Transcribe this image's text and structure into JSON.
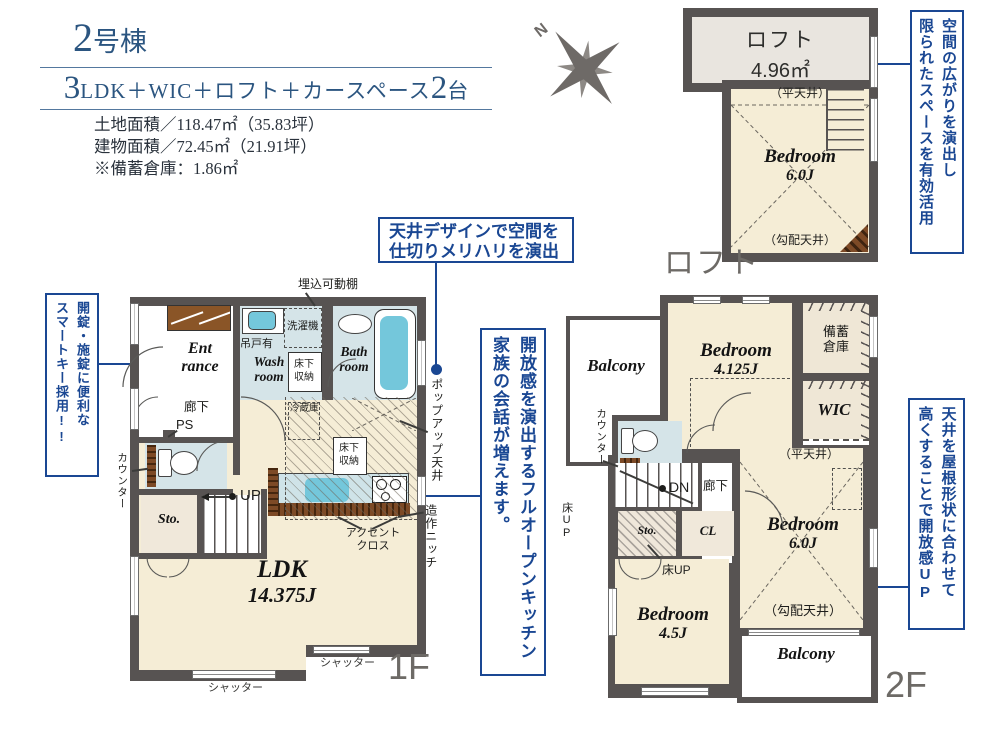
{
  "header": {
    "building_no": "2",
    "building_suffix": "号棟",
    "layout_big1": "3",
    "layout_text": "LDK＋WIC＋ロフト＋カースペース",
    "layout_big2": "2",
    "layout_unit": "台",
    "land_area": "土地面積／118.47㎡（35.83坪）",
    "building_area": "建物面積／72.45㎡（21.91坪）",
    "storage_note": "※備蓄倉庫：1.86㎡"
  },
  "compass": {
    "north": "N"
  },
  "callouts": {
    "smart_key": {
      "col_right": "開錠・施錠に便利な",
      "col_left": "スマートキー採用!!"
    },
    "ceiling_design": {
      "line1": "天井デザインで空間を",
      "line2": "仕切りメリハリを演出"
    },
    "open_kitchen": {
      "col_right": "開放感を演出するフルオープンキッチン",
      "col_left": "家族の会話が増えます。"
    },
    "loft_space": {
      "col_right": "空間の広がりを演出し",
      "col_left": "限られたスペースを有効活用"
    },
    "roof_ceiling": {
      "col_right": "天井を屋根形状に合わせて",
      "col_left": "高くすることで開放感UP"
    }
  },
  "loft": {
    "floor_label": "ロフト",
    "room": "ロフト",
    "area": "4.96㎡",
    "bedroom": "Bedroom",
    "bedroom_area": "6.0J",
    "flat_ceiling": "（平天井）",
    "slope_ceiling": "（勾配天井）"
  },
  "f1": {
    "floor_label": "1F",
    "entrance1": "Ent",
    "entrance2": "rance",
    "hallway": "廊下",
    "ps": "PS",
    "counter": "カウンター",
    "sto": "Sto.",
    "up": "UP",
    "wash1": "Wash",
    "wash2": "room",
    "hanging": "吊戸有",
    "washer": "洗濯機",
    "shelf": "埋込可動棚",
    "uf1": "床下",
    "uf2": "収納",
    "bath1": "Bath",
    "bath2": "room",
    "fridge": "冷蔵庫",
    "ldk": "LDK",
    "ldk_area": "14.375J",
    "popup": "ポップアップ天井",
    "accent1": "アクセント",
    "accent2": "クロス",
    "niche": "造作ニッチ",
    "shutter": "シャッター"
  },
  "f2": {
    "floor_label": "2F",
    "balcony": "Balcony",
    "bedroom1": "Bedroom",
    "bedroom1_area": "4.125J",
    "stock1": "備蓄",
    "stock2": "倉庫",
    "wic": "WIC",
    "counter": "カウンター",
    "dn": "DN",
    "hallway": "廊下",
    "floor_up": "床UP",
    "sto": "Sto.",
    "cl": "CL",
    "bedroom2": "Bedroom",
    "bedroom2_area": "4.5J",
    "bedroom3": "Bedroom",
    "bedroom3_area": "6.0J",
    "flat_ceiling": "（平天井）",
    "slope_ceiling": "（勾配天井）"
  }
}
